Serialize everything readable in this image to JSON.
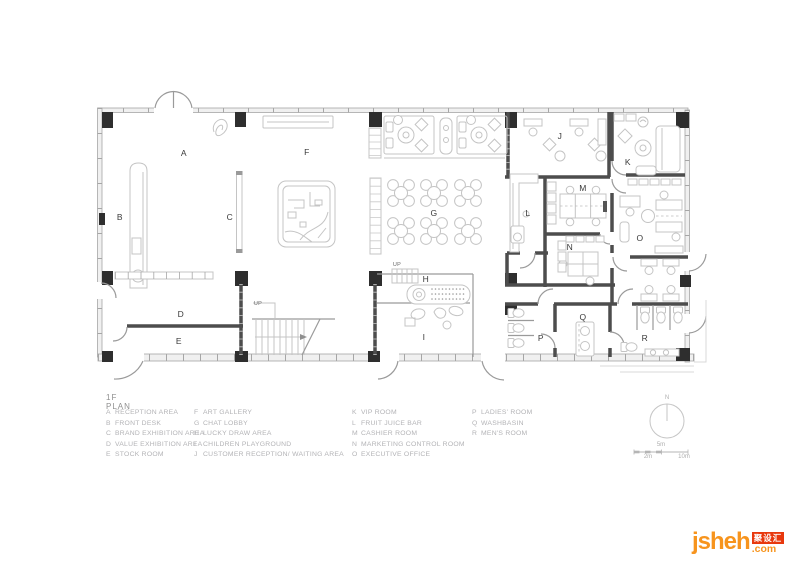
{
  "plan": {
    "title": "1F PLAN",
    "up_label": "UP",
    "compass_label": "N",
    "scale_bar": {
      "mid": "5m",
      "left": "2m",
      "right": "10m"
    }
  },
  "rooms": [
    {
      "letter": "A",
      "name": "RECEPTION AREA"
    },
    {
      "letter": "B",
      "name": "FRONT DESK"
    },
    {
      "letter": "C",
      "name": "BRAND EXHIBITION AREA"
    },
    {
      "letter": "D",
      "name": "VALUE EXHIBITION AREA"
    },
    {
      "letter": "E",
      "name": "STOCK ROOM"
    },
    {
      "letter": "F",
      "name": "ART GALLERY"
    },
    {
      "letter": "G",
      "name": "CHAT LOBBY"
    },
    {
      "letter": "H",
      "name": "LUCKY DRAW AREA"
    },
    {
      "letter": "I",
      "name": "CHILDREN PLAYGROUND"
    },
    {
      "letter": "J",
      "name": "CUSTOMER RECEPTION/ WAITING AREA"
    },
    {
      "letter": "K",
      "name": "VIP ROOM"
    },
    {
      "letter": "L",
      "name": "FRUIT JUICE BAR"
    },
    {
      "letter": "M",
      "name": "CASHIER ROOM"
    },
    {
      "letter": "N",
      "name": "MARKETING CONTROL ROOM"
    },
    {
      "letter": "O",
      "name": "EXECUTIVE OFFICE"
    },
    {
      "letter": "P",
      "name": "LADIES' ROOM"
    },
    {
      "letter": "Q",
      "name": "WASHBASIN"
    },
    {
      "letter": "R",
      "name": "MEN'S ROOM"
    }
  ],
  "watermark": {
    "brand": "jsheh",
    "suffix": ".com",
    "cn_label": "聚设汇",
    "orange": "#F7941D",
    "red": "#E8380D"
  },
  "colors": {
    "wall_dark": "#4d4d4d",
    "wall_glazed": "#a6a6a6",
    "furniture": "#c4c4c4",
    "column": "#2e2e2e",
    "room_label": "#3a3a3a",
    "legend_text": "#b3b3b6"
  }
}
